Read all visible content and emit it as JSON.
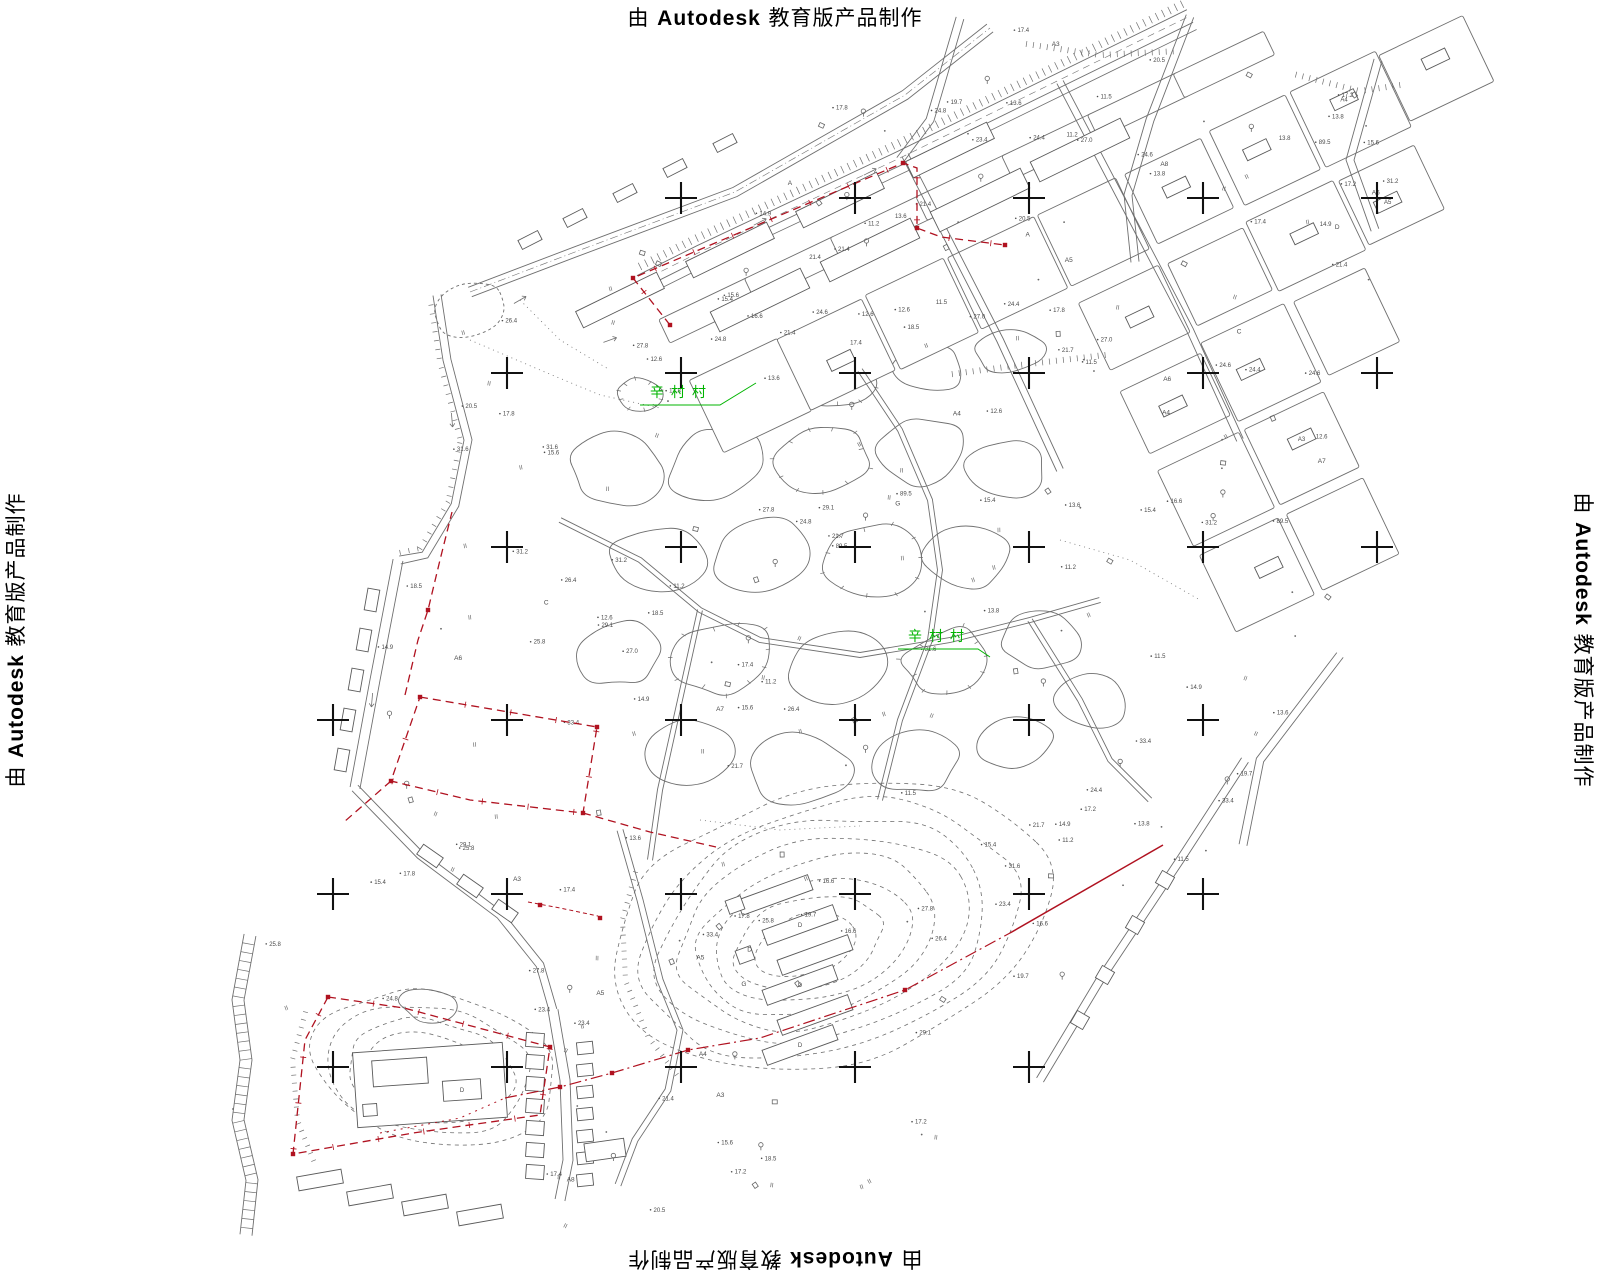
{
  "watermark": {
    "prefix": "由 ",
    "brand": "Autodesk",
    "suffix": " 教育版产品制作"
  },
  "map": {
    "village_labels": [
      {
        "text": "辛村村",
        "x": 650,
        "y": 397
      },
      {
        "text": "辛村村",
        "x": 908,
        "y": 641
      }
    ],
    "spot_heights": [
      "21.4",
      "17.4",
      "13.6",
      "11.5",
      "11.2",
      "12.6",
      "13.8",
      "14.9",
      "15.4",
      "15.6",
      "16.6",
      "17.2",
      "17.8",
      "18.5",
      "19.7",
      "20.5",
      "21.7",
      "23.4",
      "24.4",
      "24.6",
      "24.8",
      "25.8",
      "26.4",
      "27.0",
      "27.8",
      "29.1",
      "31.2",
      "31.6",
      "33.4",
      "89.5"
    ],
    "parcel_letters": [
      "A3",
      "A4",
      "A5",
      "A6",
      "A7",
      "A8",
      "C",
      "D",
      "G",
      "A"
    ],
    "paddy_mark": "II",
    "building_label": "D",
    "colors": {
      "linework": "#6f6f6f",
      "emphasis": "#111111",
      "boundary_red": "#b01220",
      "vegetation_green": "#00b400",
      "text_gray": "#4a4a4a"
    },
    "grid": {
      "cols": [
        333,
        507,
        681,
        855,
        1029,
        1203,
        1377
      ],
      "rows": [
        198,
        373,
        547,
        720,
        894,
        1067
      ]
    }
  }
}
